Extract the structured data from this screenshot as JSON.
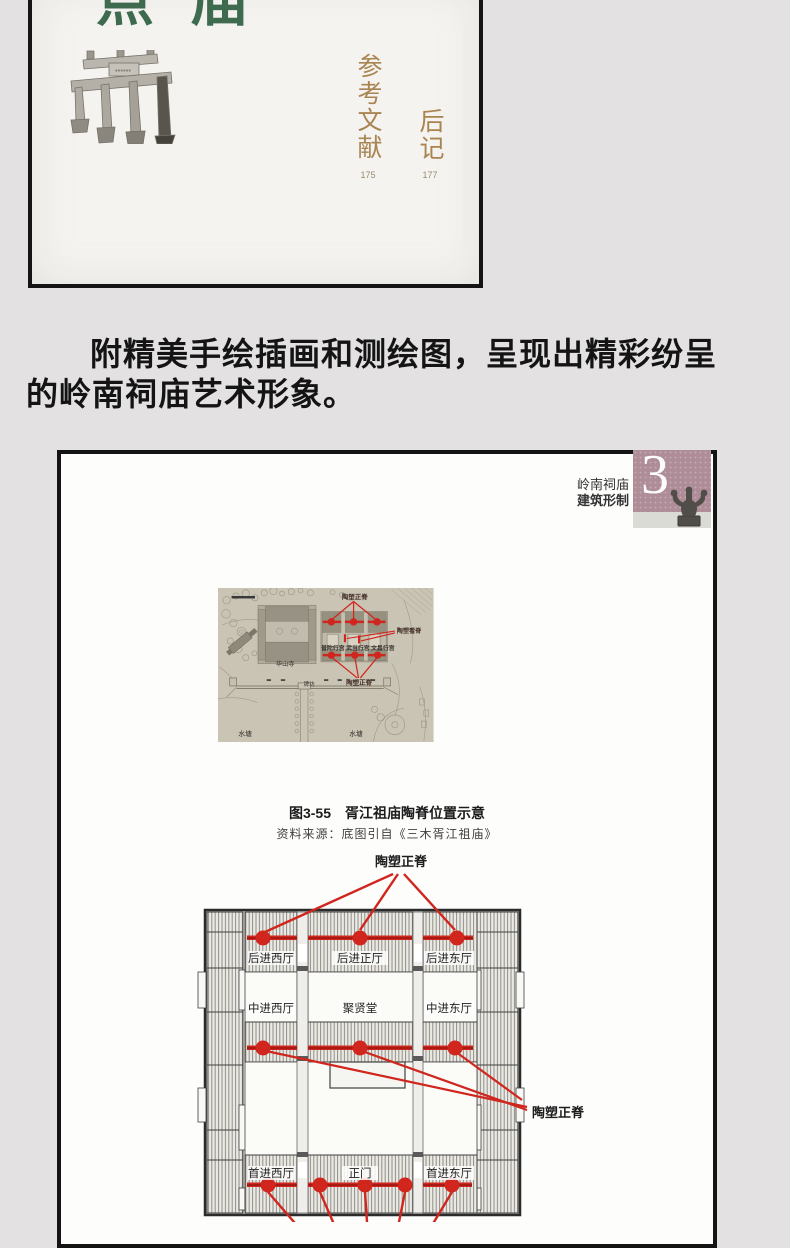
{
  "page1": {
    "title_char_1": "点",
    "title_char_2": "庙",
    "toc": {
      "references_label": "参考文献",
      "references_page": "175",
      "postscript_label": "后记",
      "postscript_page": "177"
    }
  },
  "description": {
    "line1": "附精美手绘插画和测绘图，呈现出精彩纷呈",
    "line2": "的岭南祠庙艺术形象。"
  },
  "page2": {
    "header": {
      "series": "岭南祠庙",
      "subtitle": "建筑形制",
      "chapter_number": "3"
    },
    "site_plan": {
      "labels": {
        "ridge_top": "陶塑正脊",
        "ridge_side": "陶塑看脊",
        "halls": "普陀行宫 武当行宫 文昌行宫",
        "ridge_bottom": "陶塑正脊",
        "huashan_temple": "华山寺",
        "paifang": "牌坊",
        "pond_left": "水塘",
        "pond_right": "水塘"
      },
      "caption": "图3-55　胥江祖庙陶脊位置示意",
      "source": "资料来源：底图引自《三木胥江祖庙》"
    },
    "floor_plan": {
      "ridge_label_top": "陶塑正脊",
      "ridge_label_right": "陶塑正脊",
      "rooms": {
        "rear_west": "后进西厅",
        "rear_main": "后进正厅",
        "rear_east": "后进东厅",
        "mid_west": "中进西厅",
        "hall": "聚贤堂",
        "mid_east": "中进东厅",
        "front_west": "首进西厅",
        "main_gate": "正门",
        "front_east": "首进东厅"
      }
    }
  },
  "colors": {
    "accent_red": "#d0261d",
    "chapter_badge_mauve": "#ae8c98",
    "title_green": "#3e6b4e",
    "toc_brown": "#a98450",
    "background_gray": "#e3e1e2",
    "site_plan_paper": "#cac4b5"
  }
}
